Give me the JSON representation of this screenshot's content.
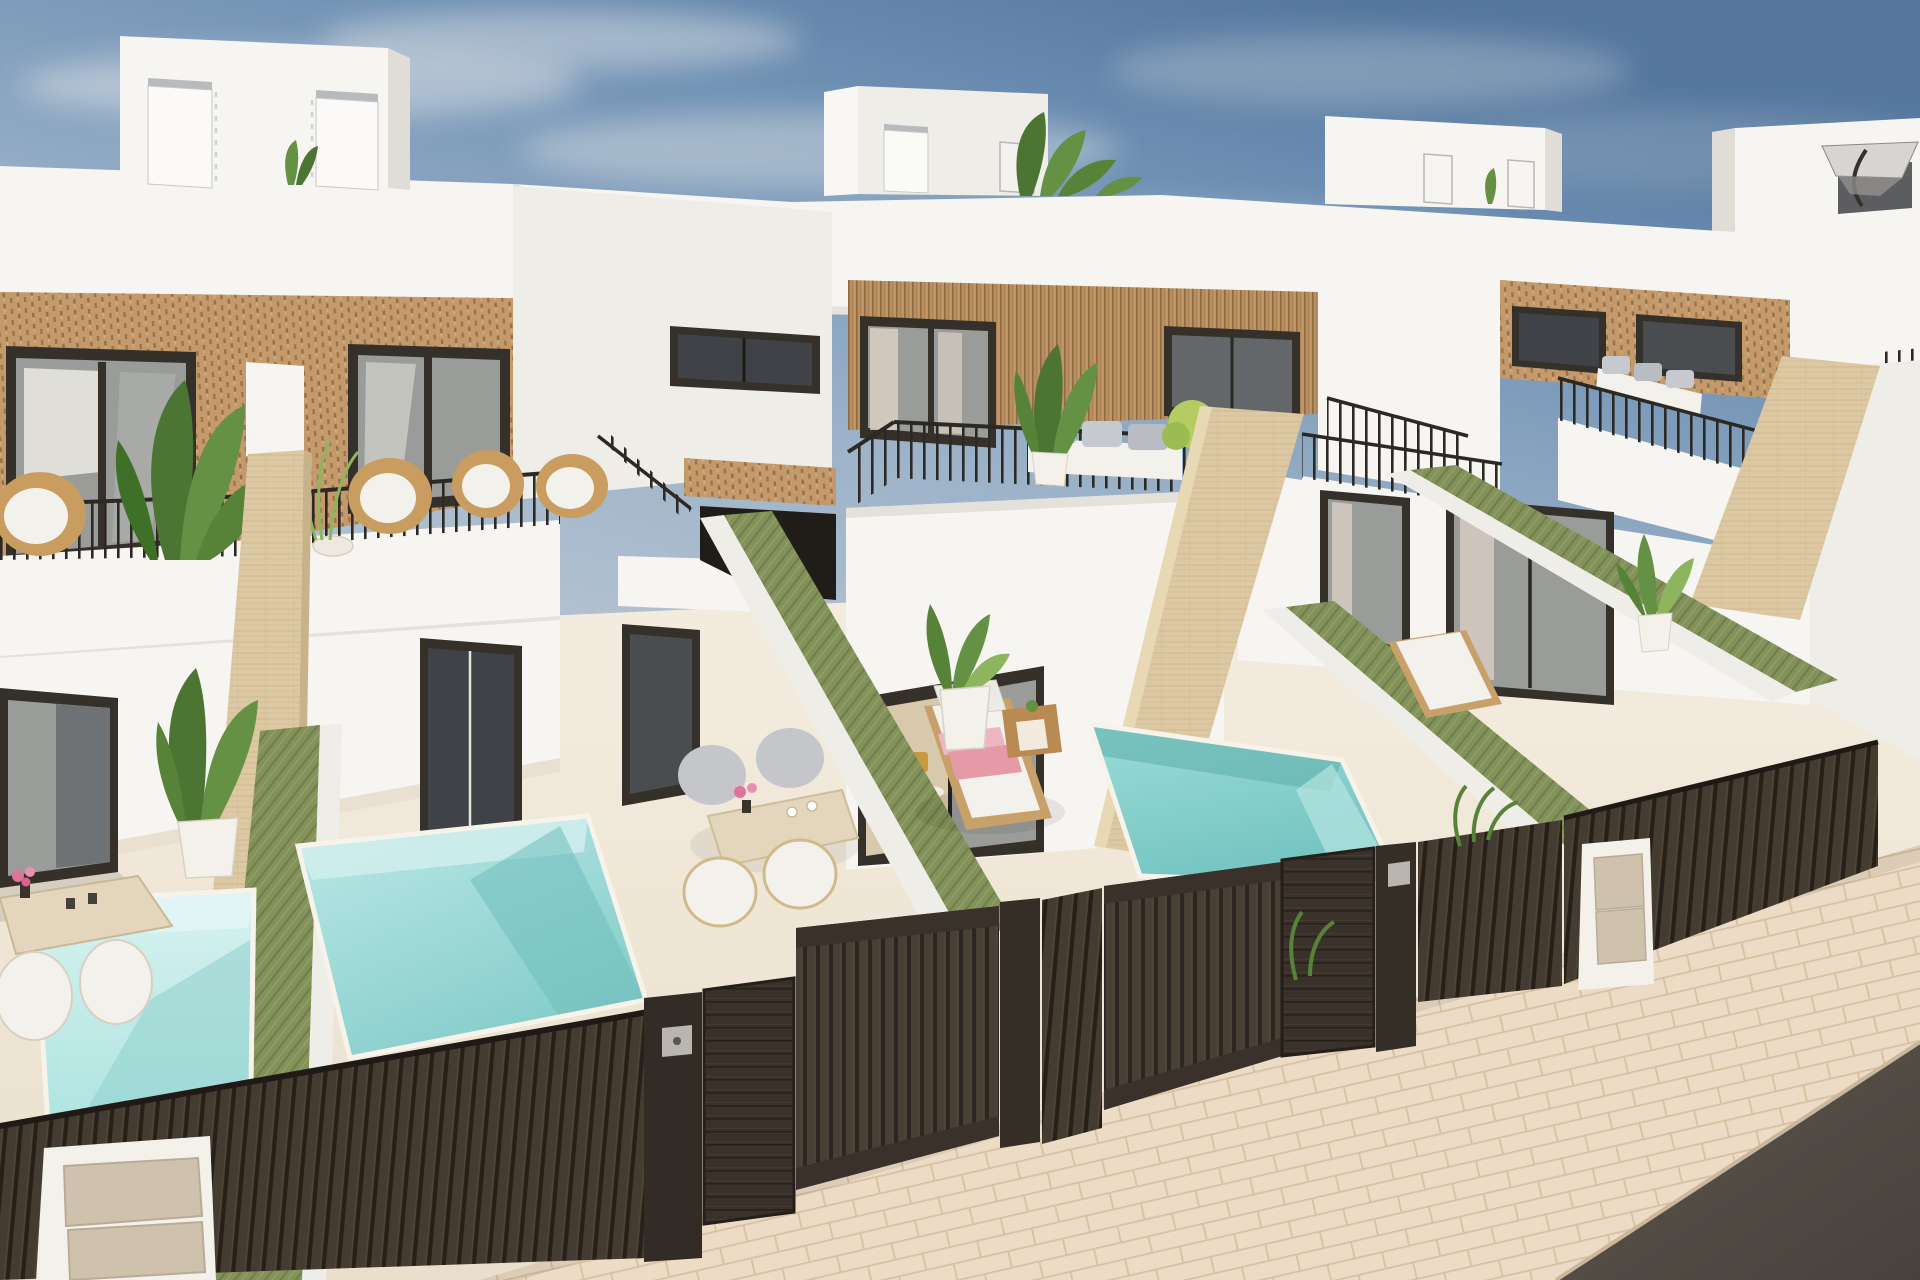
{
  "image": {
    "width": 1920,
    "height": 1280,
    "kind": "3d-architectural-render",
    "alt": "Aerial 3D render of a row of modern white two-storey townhouses with roof terraces, rattan-clad facades, green privacy walls, private plunge pools, sun loungers and dark slatted street gates"
  },
  "scene": {
    "setting": "new-build mediterranean villas, elevated street view, daytime",
    "objects": [
      "sky",
      "clouds",
      "roof-parapet",
      "roof-stair-tower",
      "tower-door",
      "rooftop-plant",
      "patio-parasol",
      "rattan-facade",
      "wood-slat-facade",
      "window",
      "sliding-glass-door",
      "balcony-railing",
      "balcony-parapet",
      "wicker-chair",
      "outdoor-sofa",
      "round-table",
      "travertine-pillar",
      "green-privacy-wall",
      "plunge-pool",
      "patio-floor",
      "sun-lounger",
      "pink-towels",
      "side-table",
      "outdoor-dining-set",
      "potted-plant",
      "street-fence",
      "driveway-gate",
      "pedestrian-gate",
      "gate-pillar",
      "gate-keypad",
      "utility-post",
      "meter-panel",
      "sidewalk",
      "road"
    ],
    "counts": {
      "houses_visible": 4,
      "pools_visible": 3,
      "sun_loungers": 2,
      "dining_sets": 2,
      "gates": 2
    },
    "colors": {
      "sky_top": "#56789f",
      "sky_mid": "#8aa3bf",
      "sky_horizon": "#c3cdd6",
      "cloud": "#d9dee3",
      "wall_white": "#f6f5f1",
      "wall_light": "#efede8",
      "wall_shadow": "#e0ddd6",
      "rattan": "#c49a6c",
      "rattan_dark": "#8a683f",
      "wood_slat": "#b98f62",
      "wood_slat_dark": "#8e6a42",
      "frame_dark": "#35302a",
      "glass_gray": "#9a9c99",
      "glass_dark": "#64676a",
      "glass_deep": "#3f4246",
      "interior_warm": "#d8c9ad",
      "curtain": "#d9d0c3",
      "green_wall": "#82925a",
      "green_wall_dark": "#6d7c48",
      "pool_pale": "#c7ecea",
      "pool_light": "#a3e0dc",
      "pool_mid": "#8ad2ce",
      "pool_deep": "#6fbdbb",
      "patio": "#f2ebdd",
      "patio_shade": "#e7dccb",
      "travertine": "#dcc9a3",
      "travertine_line": "#c8b28a",
      "fence_dark": "#2b251f",
      "fence_slat": "#463d33",
      "gate_board": "#3a322a",
      "keypad": "#b9b6b0",
      "post_white": "#f4f1eb",
      "panel_beige": "#cfc2ad",
      "railing": "#2c2824",
      "sidewalk": "#ecdbc5",
      "sidewalk_line": "#d8c1a2",
      "road": "#57504a",
      "plant_dark": "#4c7433",
      "plant_mid": "#649144",
      "plant_light": "#8db55e",
      "plant_lime": "#b5cc60",
      "lounger_wood": "#c8a06a",
      "towel_pink": "#e59aa8",
      "towel_pink_light": "#edb6c0",
      "cushion_white": "#f3f1ec",
      "sofa_gray": "#b9bcc3",
      "parasol": "#d6d5d2",
      "flower_pink": "#e0739c",
      "table_wood": "#e4d6bd",
      "wicker": "#c99c5f"
    }
  }
}
